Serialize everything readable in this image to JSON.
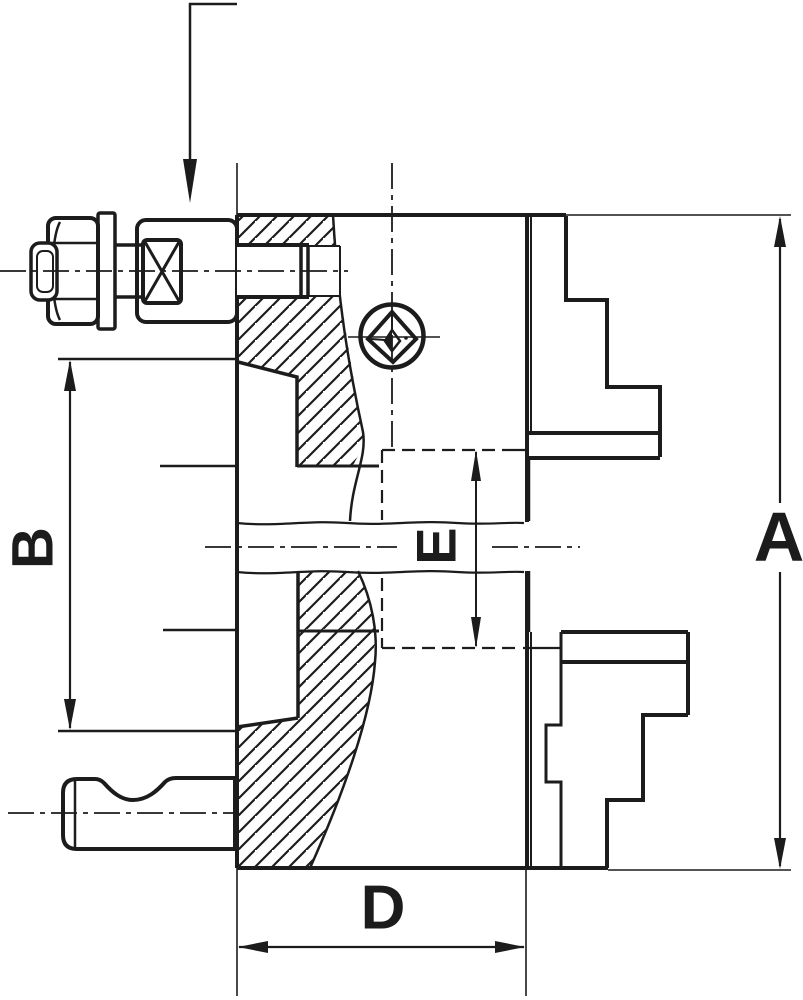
{
  "figure": {
    "type": "technical-drawing-cross-section"
  },
  "labels": {
    "dim_a": "A",
    "dim_b": "B",
    "dim_d": "D",
    "dim_e": "E"
  },
  "colors": {
    "line": "#1c1c1c",
    "background": "#ffffff"
  }
}
